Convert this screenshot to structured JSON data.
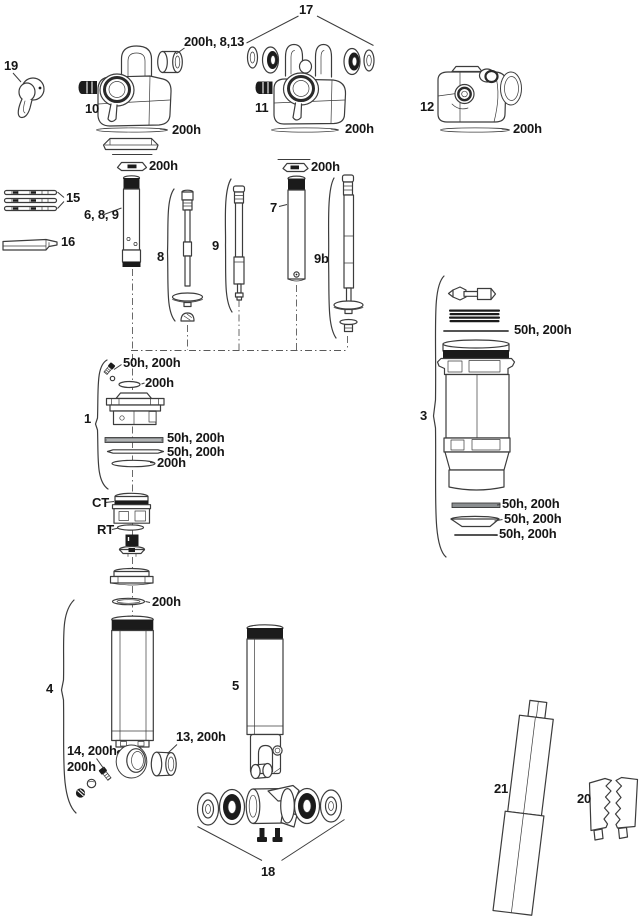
{
  "diagram": {
    "type": "exploded-parts-diagram",
    "palette": {
      "ink": "#3c3c3c",
      "dark_fill": "#1b1b1b",
      "text": "#161616",
      "background": "#ffffff"
    },
    "labels": {
      "part17": "17",
      "bushing_8_13": "200h, 8,13",
      "part19": "19",
      "part10": "10",
      "part11": "11",
      "part12": "12",
      "rod10": "200h",
      "rod11": "200h",
      "rod12": "200h",
      "seal10": "200h",
      "seal11": "200h",
      "part15": "15",
      "part689": "6, 8, 9",
      "part7": "7",
      "part16": "16",
      "part8": "8",
      "part9": "9",
      "part9b": "9b",
      "p3_rod": "50h, 200h",
      "part3": "3",
      "p1_screw": "50h, 200h",
      "p1_oring": "200h",
      "part1": "1",
      "p1_seal1": "50h, 200h",
      "p1_seal2": "50h, 200h",
      "p1_oring2": "200h",
      "ct": "CT",
      "rt": "RT",
      "p3_seal1": "50h, 200h",
      "p3_seal2": "50h, 200h",
      "p3_seal3": "50h, 200h",
      "p4_oring": "200h",
      "part4": "4",
      "part5": "5",
      "part13": "13, 200h",
      "part14": "14, 200h",
      "p4_ball": "200h",
      "part21": "21",
      "part20": "20",
      "part18": "18"
    }
  }
}
